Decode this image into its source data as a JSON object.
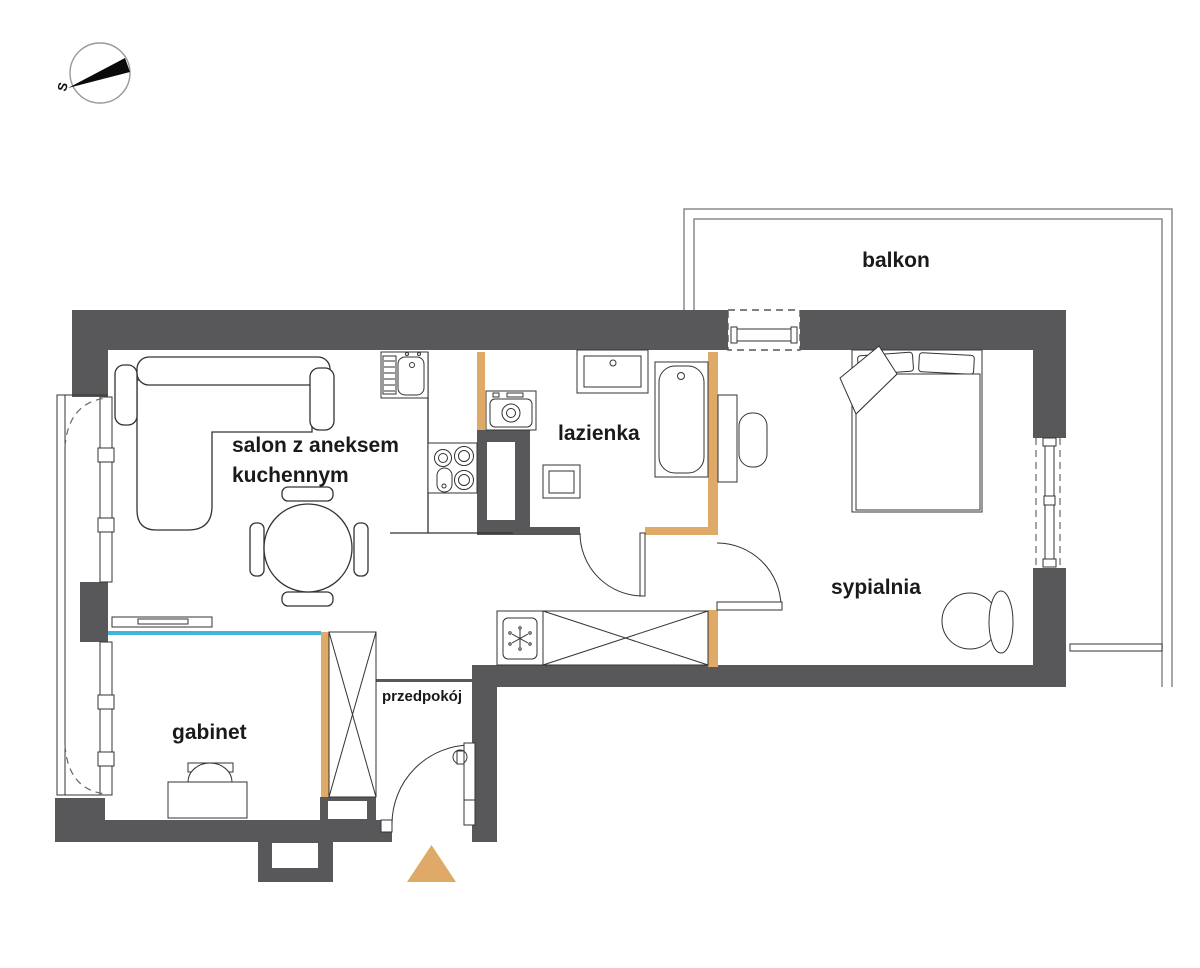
{
  "rooms": {
    "balkon": "balkon",
    "salon_line1": "salon z aneksem",
    "salon_line2": "kuchennym",
    "lazienka": "lazienka",
    "sypialnia": "sypialnia",
    "gabinet": "gabinet",
    "przedpokoj": "przedpokój"
  },
  "compass": {
    "label": "S"
  },
  "colors": {
    "wall": "#58585a",
    "wood": "#dfa968",
    "glass": "#41b6dc",
    "line": "#333333",
    "balcony_line": "#8a8a8a",
    "background": "#ffffff",
    "compass_wedge": "#0a0a0a",
    "label_text": "#1a1a1a"
  },
  "fixtures": {
    "sofa": "corner-sofa",
    "dining_table": "round-table-4-chairs",
    "tv_sideboard": "tv-sideboard",
    "kitchen_sink": "kitchen-sink",
    "cooktop": "cooktop-4-burners",
    "ventilation_shaft": "ventilation-shaft",
    "washing_machine": "washing-machine",
    "washbasin": "washbasin",
    "bathtub": "bathtub",
    "toilet": "toilet",
    "fridge": "fridge",
    "hall_wardrobe": "wardrobe",
    "gabinet_wardrobe": "wardrobe",
    "office_desk": "desk-with-chair",
    "bedroom_desk": "desk-with-chair",
    "bed": "double-bed",
    "armchair": "armchair-with-footstool",
    "entrance_door": "entrance-door",
    "entrance_marker": "entrance-triangle",
    "glass_partition": "glass-partition"
  }
}
